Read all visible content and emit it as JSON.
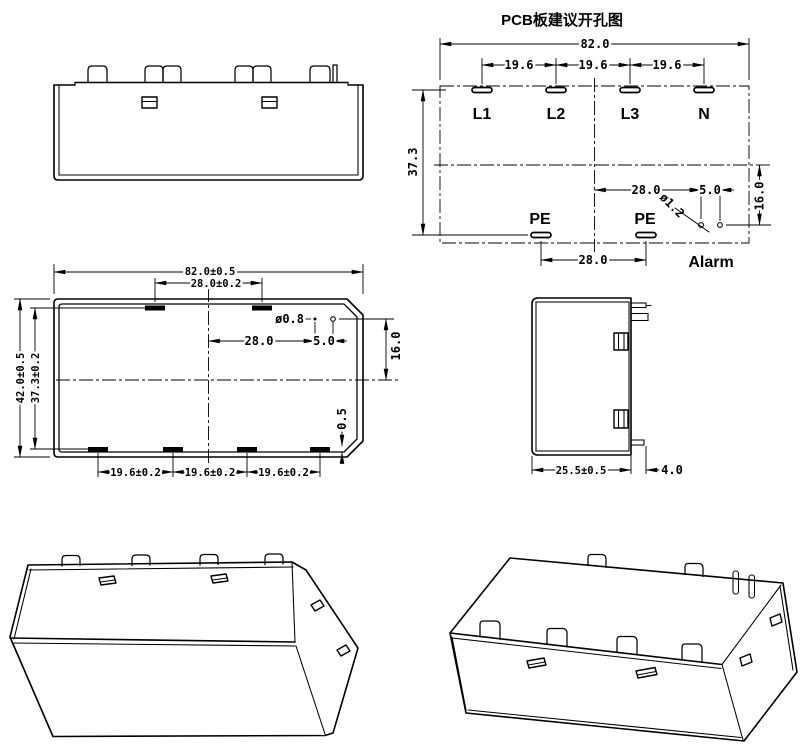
{
  "pcb_view": {
    "title": "PCB板建议开孔图",
    "terminals": {
      "l1": "L1",
      "l2": "L2",
      "l3": "L3",
      "n": "N",
      "pe_left": "PE",
      "pe_right": "PE",
      "alarm": "Alarm"
    },
    "dims": {
      "overall_width": "82.0",
      "pitch_a": "19.6",
      "pitch_b": "19.6",
      "pitch_c": "19.6",
      "row_spacing": "37.3",
      "alarm_offset_x": "28.0",
      "alarm_pitch": "5.0",
      "alarm_offset_y": "16.0",
      "alarm_hole_dia": "ø1.2",
      "pe_spacing": "28.0"
    }
  },
  "bottom_view": {
    "dims": {
      "overall_width": "82.0±0.5",
      "top_slot_spacing": "28.0±0.2",
      "overall_depth": "42.0±0.5",
      "row_spacing": "37.3±0.2",
      "hole_dia": "ø0.8",
      "hole_offset_x": "28.0",
      "hole_pitch": "5.0",
      "hole_offset_y": "16.0",
      "slot_inset": "0.5",
      "pitch_a": "19.6±0.2",
      "pitch_b": "19.6±0.2",
      "pitch_c": "19.6±0.2"
    }
  },
  "side_view": {
    "dims": {
      "body_depth": "25.5±0.5",
      "pin_length": "4.0"
    }
  },
  "style": {
    "line_color": "#000000",
    "background": "#ffffff"
  }
}
